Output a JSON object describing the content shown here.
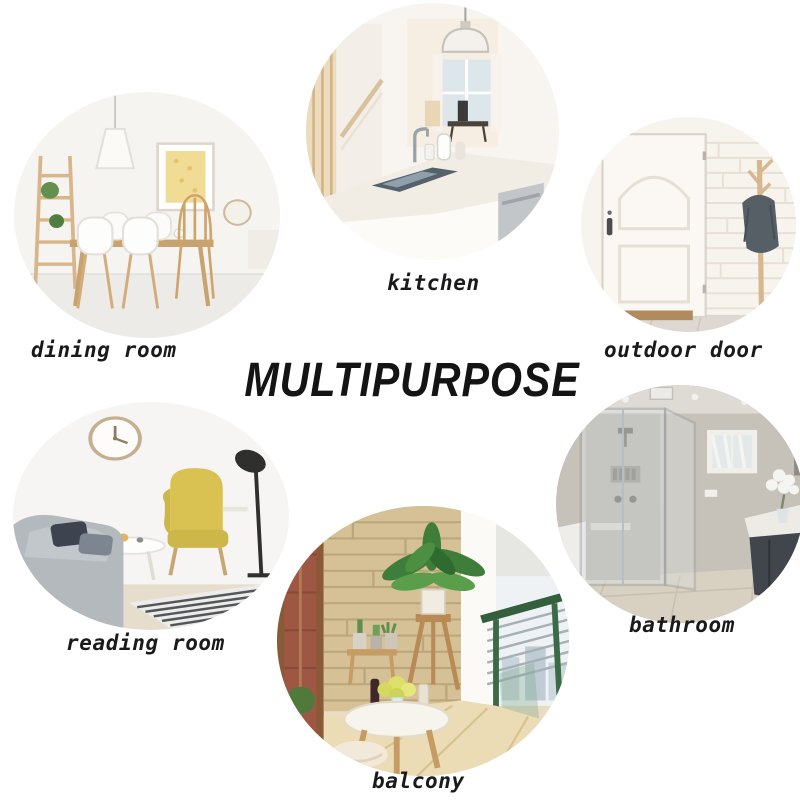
{
  "title": "MULTIPURPOSE",
  "rooms": [
    {
      "id": "dining-room",
      "label": "dining room",
      "scene": "white dining room with wooden table, white shell chairs, pendant lamp, ladder plant shelf and gold dotted art print"
    },
    {
      "id": "kitchen",
      "label": "kitchen",
      "scene": "white kitchen island with dark sink, chrome faucet, dome pendant lamp, staircase and window"
    },
    {
      "id": "outdoor-door",
      "label": "outdoor door",
      "scene": "white panel door with dark handle, white brick wall, wooden coat rack with grey jacket, brown doormat"
    },
    {
      "id": "reading-room",
      "label": "reading room",
      "scene": "reading corner with wall clock, black floor lamp, yellow wingback armchair, grey sofa with pillows, round white table and striped rug"
    },
    {
      "id": "balcony",
      "label": "balcony",
      "scene": "balcony with tan stone wall, red brick window view, potted plants on stand, round white table with flowers and wine, plush stool, green cable railing"
    },
    {
      "id": "bathroom",
      "label": "bathroom",
      "scene": "bathroom with glass walk-in shower, grey tile, small curtained window, white vanity counter, dark cabinet and white flowers"
    }
  ],
  "colors": {
    "background": "#ffffff",
    "text": "#1a1a1a",
    "armchair_yellow": "#d5bf55",
    "wood": "#c9a06a",
    "stone_tan": "#d2bc8c",
    "brick_red": "#9e5743",
    "leaf_green": "#3f7d3b",
    "railing_green": "#335f3d",
    "jacket_grey": "#565e66",
    "gold_art": "#eed894"
  }
}
